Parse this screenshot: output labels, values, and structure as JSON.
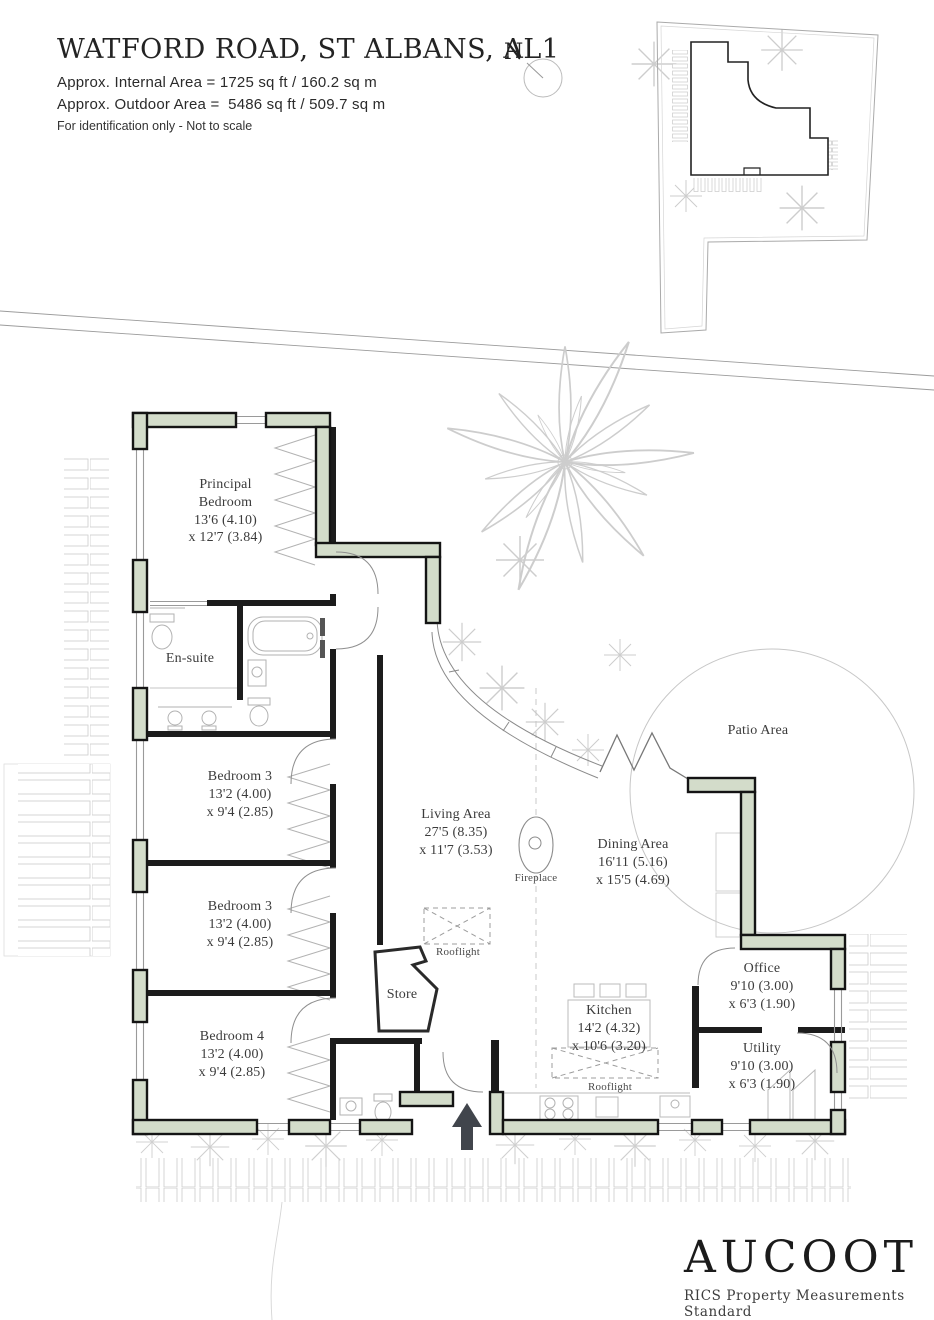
{
  "header": {
    "title": "WATFORD ROAD, ST ALBANS, AL1",
    "internal_area": "Approx. Internal Area = 1725 sq ft / 160.2 sq m",
    "outdoor_area": "Approx. Outdoor Area =  5486 sq ft / 509.7 sq m",
    "note": "For identification only - Not to scale"
  },
  "north_indicator": {
    "label": "N"
  },
  "rooms": {
    "principal": {
      "name": "Principal Bedroom",
      "dim1": "13'6 (4.10)",
      "dim2": "x 12'7 (3.84)"
    },
    "ensuite": {
      "name": "En-suite"
    },
    "bedroom3a": {
      "name": "Bedroom 3",
      "dim1": "13'2 (4.00)",
      "dim2": "x 9'4 (2.85)"
    },
    "bedroom3b": {
      "name": "Bedroom 3",
      "dim1": "13'2 (4.00)",
      "dim2": "x 9'4 (2.85)"
    },
    "bedroom4": {
      "name": "Bedroom 4",
      "dim1": "13'2 (4.00)",
      "dim2": "x 9'4 (2.85)"
    },
    "living": {
      "name": "Living Area",
      "dim1": "27'5 (8.35)",
      "dim2": "x 11'7 (3.53)"
    },
    "dining": {
      "name": "Dining Area",
      "dim1": "16'11 (5.16)",
      "dim2": "x 15'5 (4.69)"
    },
    "kitchen": {
      "name": "Kitchen",
      "dim1": "14'2 (4.32)",
      "dim2": "x 10'6 (3.20)"
    },
    "office": {
      "name": "Office",
      "dim1": "9'10 (3.00)",
      "dim2": "x 6'3 (1.90)"
    },
    "utility": {
      "name": "Utility",
      "dim1": "9'10 (3.00)",
      "dim2": "x 6'3 (1.90)"
    },
    "store": {
      "name": "Store"
    },
    "patio": {
      "name": "Patio Area"
    },
    "fireplace": {
      "name": "Fireplace"
    },
    "rooflight": {
      "name": "Rooflight"
    }
  },
  "footer": {
    "brand": "AUCOOT",
    "standard": "RICS Property Measurements Standard"
  },
  "colors": {
    "wall_fill": "#d3dcca",
    "wall_stroke": "#141414",
    "entrance_arrow": "#41454c"
  }
}
